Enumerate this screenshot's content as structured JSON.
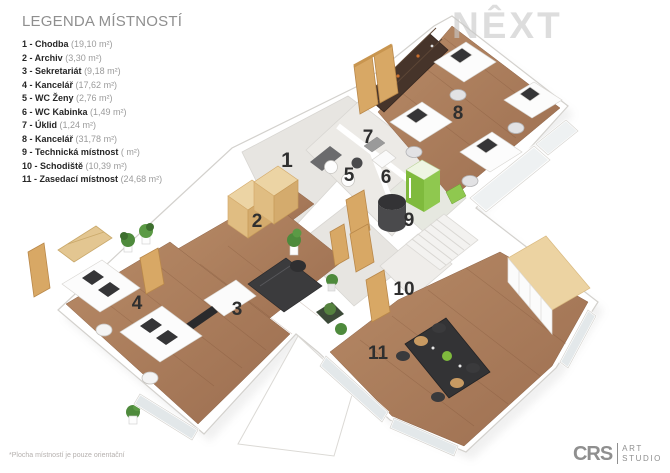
{
  "legend": {
    "title": "LEGENDA MÍSTNOSTÍ",
    "items": [
      {
        "label": "1 - Chodba",
        "area": "(19,10 m²)"
      },
      {
        "label": "2 - Archiv",
        "area": "(3,30 m²)"
      },
      {
        "label": "3 - Sekretariát",
        "area": "(9,18 m²)"
      },
      {
        "label": "4 - Kancelář",
        "area": "(17,62 m²)"
      },
      {
        "label": "5 - WC Ženy",
        "area": "(2,76 m²)"
      },
      {
        "label": "6 - WC Kabinka",
        "area": "(1,49 m²)"
      },
      {
        "label": "7 - Úklid",
        "area": "(1,24 m²)"
      },
      {
        "label": "8 - Kancelář",
        "area": "(31,78 m²)"
      },
      {
        "label": "9 - Technická místnost",
        "area": "( m²)"
      },
      {
        "label": "10 - Schodiště",
        "area": "(10,39 m²)"
      },
      {
        "label": "11 - Zasedací místnost",
        "area": "(24,68 m²)"
      }
    ]
  },
  "plan": {
    "room_numbers": [
      "1",
      "2",
      "3",
      "4",
      "5",
      "6",
      "7",
      "8",
      "9",
      "10",
      "11"
    ]
  },
  "watermark": "NÊXT",
  "footnote": "*Plocha místností je pouze orientační",
  "logo": {
    "brand": "CRS",
    "line1": "ART",
    "line2": "STUDIO"
  },
  "colors": {
    "wood_floor": "#a97b5a",
    "light_floor": "#e8e6e2",
    "door_wood": "#d8a865",
    "accent_green": "#7fba3d",
    "furniture_dark": "#39393b",
    "wall_edge": "#d3d1cd",
    "watermark_gray": "#c9c9c9"
  }
}
